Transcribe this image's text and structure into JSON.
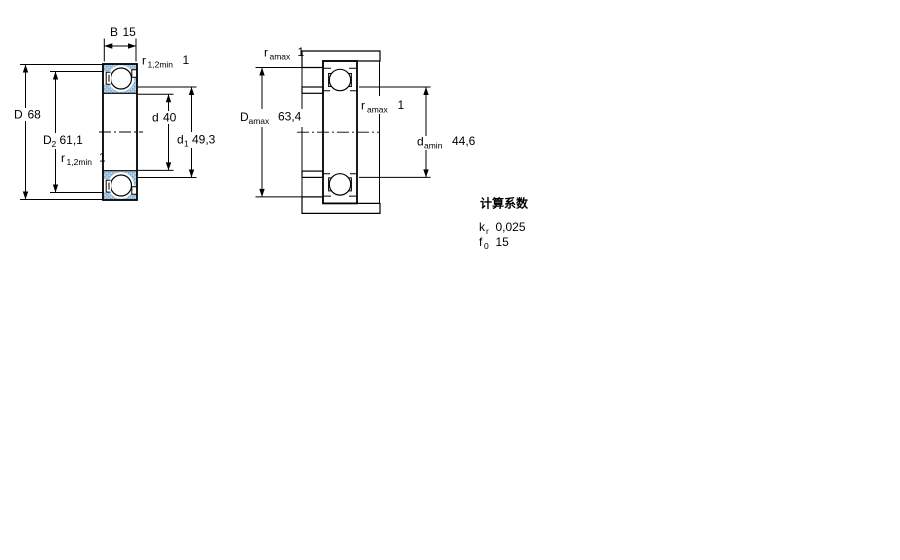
{
  "left_view": {
    "b": {
      "sym": "B",
      "value": "15"
    },
    "r_top": {
      "sym": "r",
      "sub": "1,2min",
      "value": "1"
    },
    "D": {
      "sym": "D",
      "value": "68"
    },
    "D2": {
      "sym": "D",
      "sub": "2",
      "value": "61,1"
    },
    "r_bottom": {
      "sym": "r",
      "sub": "1,2min",
      "value": "1"
    },
    "d": {
      "sym": "d",
      "value": "40"
    },
    "d1": {
      "sym": "d",
      "sub": "1",
      "value": "49,3"
    }
  },
  "right_view": {
    "r_top": {
      "sym": "r",
      "sub": "amax",
      "value": "1"
    },
    "Da": {
      "sym": "D",
      "sub": "amax",
      "value": "63,4"
    },
    "r_mid": {
      "sym": "r",
      "sub": "amax",
      "value": "1"
    },
    "da": {
      "sym": "d",
      "sub": "amin",
      "value": "44,6"
    }
  },
  "factors": {
    "title": "计算系数",
    "k_sym": "k",
    "k_sub": "r",
    "k_value": "0,025",
    "f_sym": "f",
    "f_sub": "0",
    "f_value": "15"
  },
  "colors": {
    "hatch_base": "#b7d3ea",
    "hatch_dot": "#78a6d2",
    "line": "#000000",
    "background": "#ffffff"
  }
}
